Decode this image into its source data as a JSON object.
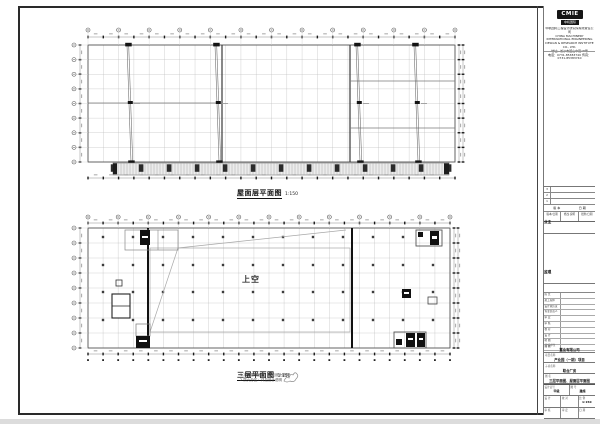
{
  "plan_roof": {
    "title": "屋面层平面图",
    "scale": "1:150",
    "grid_cols": 24,
    "grid_rows": 8
  },
  "plan_third": {
    "title": "三层平面图",
    "scale": "1:150",
    "void_label": "上空",
    "notes": [
      "1.本层建筑面积：详见设计说明",
      "2.防火分区：详见设计说明"
    ],
    "grid_cols": 24,
    "grid_rows": 8
  },
  "titleblock": {
    "logo": "CMIE",
    "logo_sub": "中机国际",
    "company_lines": [
      "中机国际工程设计研究院有限责任公司",
      "CHINA MACHINERY INTERNATIONAL ENGINEERING",
      "DESIGN & RESEARCH INSTITUTE CO., LTD.",
      "地址：长沙市韶山中路18号",
      "电话：0731-85383740  传真：0731-85383740"
    ],
    "revision": {
      "header_version": "版 本",
      "header_date": "日 期",
      "columns": [
        "版本/日期",
        "修改·说明",
        "批准/日期"
      ],
      "empty_rows": 3
    },
    "owner_label": "业主",
    "supervisor_label": "监理",
    "sign_rows": [
      "院 长",
      "总工程师",
      "设计总负责",
      "专业负责人",
      "审 定",
      "审 核",
      "校 对",
      "设 计",
      "制 图",
      "描 图"
    ],
    "project_rows": [
      {
        "label": "建设单位",
        "value": "置业有限公司"
      },
      {
        "label": "项目名称",
        "value": "产业园（一期）项目"
      },
      {
        "label": "子项名称",
        "value": "联合厂房"
      },
      {
        "label": "图 名",
        "value": "三层平面图、屋面层平面图"
      }
    ],
    "bottom_grid": [
      [
        {
          "l": "设计证号",
          "v": "甲级"
        },
        {
          "l": "图 号",
          "v": "建施"
        }
      ],
      [
        {
          "l": "设 计",
          "v": ""
        },
        {
          "l": "校 对",
          "v": ""
        },
        {
          "l": "比 例",
          "v": "1:150"
        }
      ],
      [
        {
          "l": "审 核",
          "v": ""
        },
        {
          "l": "审 定",
          "v": ""
        },
        {
          "l": "日 期",
          "v": ""
        }
      ]
    ]
  },
  "colors": {
    "frame": "#2a2a2a",
    "grid_light": "#bdbdbd",
    "wall_dark": "#111111",
    "hatch_bg": "#ececec"
  }
}
